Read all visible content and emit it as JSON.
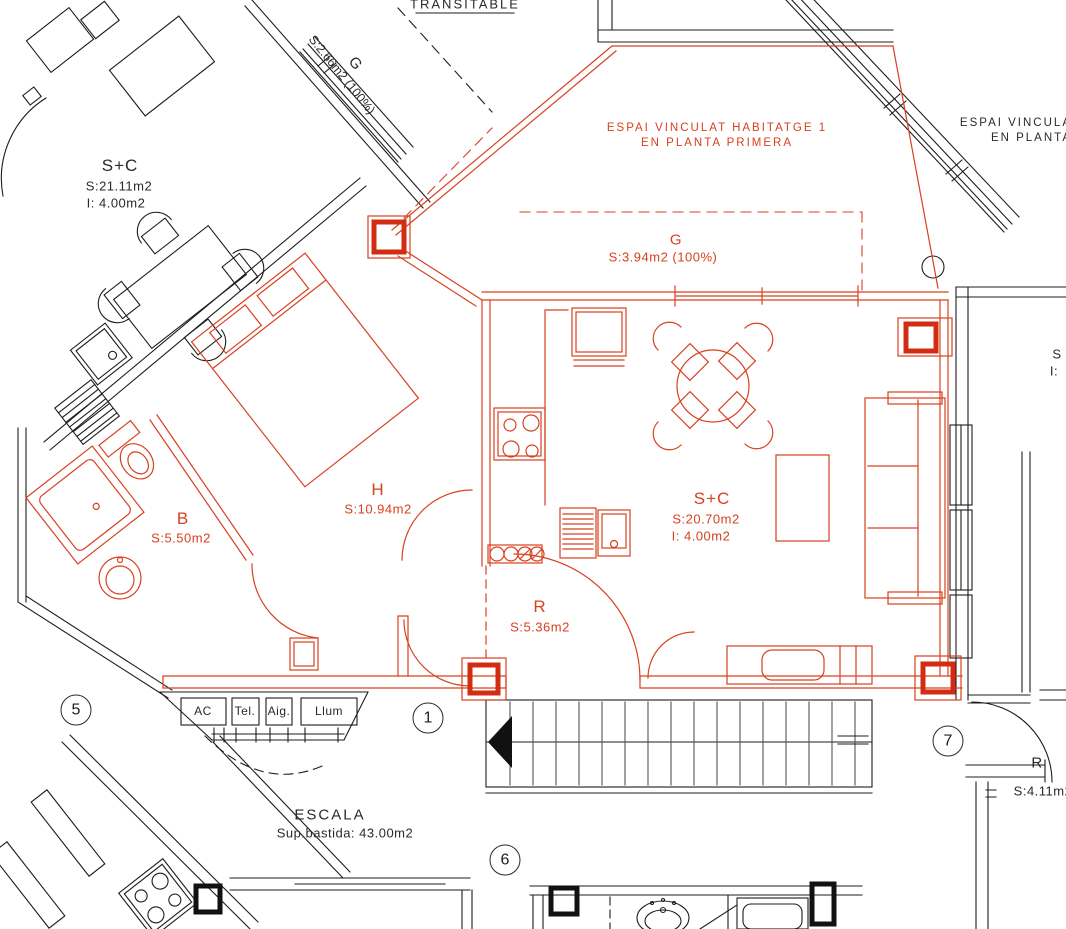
{
  "drawing": {
    "kind": "architectural floor plan",
    "colors": {
      "highlight_red": "#D8401F",
      "pillar_red": "#D22D12",
      "line_black": "#1D1D1D"
    }
  },
  "labels": {
    "transitable": "TRANSITABLE",
    "terrace_upper": {
      "room": "G",
      "area": "S:2.66m2 (100%)"
    },
    "espai_red": {
      "line1": "ESPAI VINCULAT HABITATGE 1",
      "line2": "EN PLANTA PRIMERA"
    },
    "espai_right": {
      "line1": "ESPAI VINCULA",
      "line2": "EN PLANTA"
    },
    "terrace_main": {
      "room": "G",
      "area": "S:3.94m2 (100%)"
    },
    "room_sc_neighbor": {
      "room": "S+C",
      "area": "S:21.11m2",
      "storage": "I: 4.00m2"
    },
    "room_h": {
      "room": "H",
      "area": "S:10.94m2"
    },
    "room_b": {
      "room": "B",
      "area": "S:5.50m2"
    },
    "room_sc_main": {
      "room": "S+C",
      "area": "S:20.70m2",
      "storage": "I: 4.00m2"
    },
    "room_r_main": {
      "room": "R",
      "area": "S:5.36m2"
    },
    "room_r_right": {
      "room": "R",
      "area": "S:4.11m2"
    },
    "edge_partial": {
      "line1": "S",
      "line2": "I:"
    },
    "stairwell": {
      "title": "ESCALA",
      "subtitle": "Sup.bastida: 43.00m2"
    },
    "utility_boxes": [
      "AC",
      "Tel.",
      "Aig.",
      "Llum"
    ],
    "plan_markers": [
      "5",
      "1",
      "7",
      "6"
    ]
  }
}
